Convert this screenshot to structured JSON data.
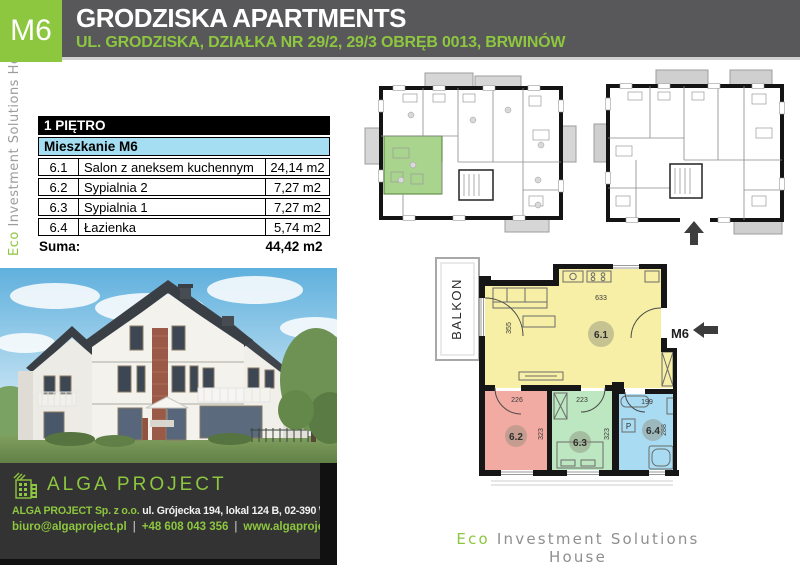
{
  "header": {
    "badge": "M6",
    "title": "GRODZISKA APARTMENTS",
    "subtitle": "UL. GRODZISKA, DZIAŁKA NR 29/2, 29/3 OBRĘB 0013, BRWINÓW"
  },
  "side_brand": {
    "eco": "Eco",
    "rest": " Investment Solutions House"
  },
  "area_table": {
    "floor_header": "1 PIĘTRO",
    "unit_header": "Mieszkanie M6",
    "rows": [
      {
        "no": "6.1",
        "name": "Salon z aneksem kuchennym",
        "area": "24,14 m2"
      },
      {
        "no": "6.2",
        "name": "Sypialnia 2",
        "area": "7,27 m2"
      },
      {
        "no": "6.3",
        "name": "Sypialnia 1",
        "area": "7,27 m2"
      },
      {
        "no": "6.4",
        "name": "Łazienka",
        "area": "5,74 m2"
      }
    ],
    "total_label": "Suma:",
    "total_value": "44,42 m2"
  },
  "unit_plan": {
    "balcony_label": "BALKON",
    "unit_label": "M6",
    "washer_label": "P",
    "rooms": [
      {
        "id": "6.1",
        "width_cm": "633",
        "depth_cm": "355"
      },
      {
        "id": "6.2",
        "width_cm": "226",
        "depth_cm": "323"
      },
      {
        "id": "6.3",
        "width_cm": "223",
        "depth_cm": "323"
      },
      {
        "id": "6.4",
        "width_cm": "199",
        "depth_cm": "288"
      }
    ]
  },
  "contact": {
    "logo_text": "ALGA PROJECT",
    "company": "ALGA PROJECT Sp. z o.o.",
    "address": "ul. Grójecka 194, lokal 124 B,  02-390 Warszawa",
    "email": "biuro@algaproject.pl",
    "phone": "+48 608 043 356",
    "website": "www.algaproject.pl",
    "separator": "|"
  },
  "footer_brand": {
    "eco": "Eco",
    "rest": " Investment Solutions House"
  },
  "colors": {
    "accent_green": "#8dc63f",
    "header_gray": "#58585b",
    "table_header_blue": "#a5def2",
    "room_salon_yellow": "#f6efa5",
    "room_sypialnia2_pink": "#f2aba2",
    "room_sypialnia1_green": "#bce7c0",
    "room_lazienka_blue": "#a9dcf2"
  }
}
